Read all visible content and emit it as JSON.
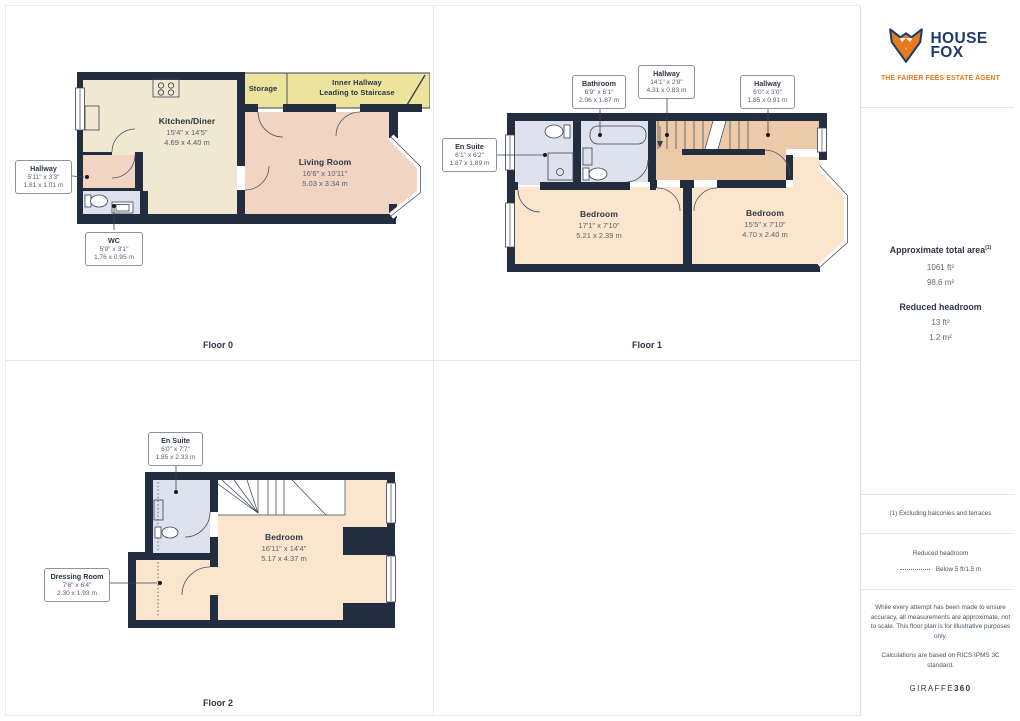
{
  "colors": {
    "wall": "#232d40",
    "kitchen": "#f1e8d1",
    "living": "#f2d4c3",
    "bath": "#dde2ee",
    "yellow": "#ece39c",
    "hall_tan": "#ecc9a8",
    "bedroom": "#fbe6cd",
    "brand_navy": "#1c3a6b",
    "brand_orange": "#e87a1e",
    "ink": "#2b3547",
    "dim_text": "#57616e",
    "grid_line": "#e8e8e8"
  },
  "floors": [
    {
      "caption": "Floor 0",
      "rooms": [
        {
          "name": "Kitchen/Diner",
          "imperial": "15'4\" x 14'5\"",
          "metric": "4.69 x 4.40 m"
        },
        {
          "name": "Living Room",
          "imperial": "16'6\" x 10'11\"",
          "metric": "5.03 x 3.34 m"
        },
        {
          "name": "Storage"
        },
        {
          "name": "Inner Hallway",
          "name2": "Leading to Staircase"
        }
      ],
      "callouts": [
        {
          "name": "Hallway",
          "imperial": "5'11\" x 3'3\"",
          "metric": "1.81 x 1.01 m"
        },
        {
          "name": "WC",
          "imperial": "5'9\" x 3'1\"",
          "metric": "1.76 x 0.95 m"
        }
      ]
    },
    {
      "caption": "Floor 1",
      "rooms": [
        {
          "name": "Bedroom",
          "imperial": "17'1\" x 7'10\"",
          "metric": "5.21 x 2.39 m"
        },
        {
          "name": "Bedroom",
          "imperial": "15'5\" x 7'10\"",
          "metric": "4.70 x 2.40 m"
        }
      ],
      "callouts": [
        {
          "name": "Bathroom",
          "imperial": "6'9\" x 6'1\"",
          "metric": "2.06 x 1.87 m"
        },
        {
          "name": "Hallway",
          "imperial": "14'1\" x 2'8\"",
          "metric": "4.31 x 0.83 m"
        },
        {
          "name": "Hallway",
          "imperial": "6'0\" x 3'0\"",
          "metric": "1.85 x 0.91 m"
        },
        {
          "name": "En Suite",
          "imperial": "6'1\" x 6'2\"",
          "metric": "1.87 x 1.89 m"
        }
      ]
    },
    {
      "caption": "Floor 2",
      "rooms": [
        {
          "name": "Bedroom",
          "imperial": "16'11\" x 14'4\"",
          "metric": "5.17 x 4.37 m"
        }
      ],
      "callouts": [
        {
          "name": "En Suite",
          "imperial": "6'0\" x 7'7\"",
          "metric": "1.85 x 2.33 m"
        },
        {
          "name": "Dressing Room",
          "imperial": "7'6\" x 6'4\"",
          "metric": "2.30 x 1.93 m"
        }
      ]
    }
  ],
  "sidebar": {
    "brand": {
      "word1": "HOUSE",
      "word2": "FOX",
      "tagline": "THE FAIRER FEES ESTATE AGENT"
    },
    "area": {
      "title": "Approximate total area",
      "sup": "(1)",
      "ft": "1061 ft²",
      "m": "98.6 m²"
    },
    "headroom": {
      "title": "Reduced headroom",
      "ft": "13 ft²",
      "m": "1.2 m²"
    },
    "footnote": "(1) Excluding balconies and terraces",
    "legend": {
      "title": "Reduced headroom",
      "item": "Below 5 ft/1.5 m"
    },
    "disclaimer1": "While every attempt has been made to ensure accuracy, all measurements are approximate, not to scale. This floor plan is for illustrative purposes only.",
    "disclaimer2": "Calculations are based on RICS IPMS 3C standard.",
    "watermark1": "GIRAFFE",
    "watermark2": "360"
  }
}
